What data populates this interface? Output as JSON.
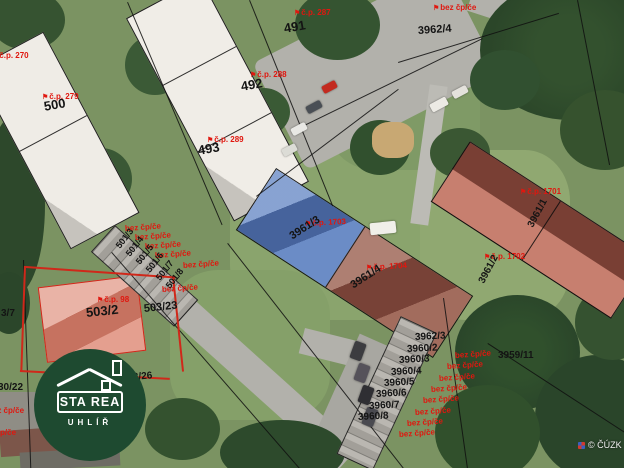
{
  "colors": {
    "label-red": "#e0170f",
    "label-black": "#141414",
    "highlight-blue": "#5a7fc0",
    "building-red-tint": "#9a5f4f",
    "house-salmon": "#e09280",
    "parcel-red-line": "#d0281a",
    "logo-green": "#1E4A30"
  },
  "icons": {
    "flag": "⚑"
  },
  "logo": {
    "line1": "STA REA",
    "line2": "UHLÍŘ"
  },
  "watermark": {
    "copyright": "© ČÚZK"
  },
  "labels": {
    "red": {
      "cp270": "č.p. 270",
      "cp279": "č.p. 279",
      "cp287": "č.p. 287",
      "cp288": "č.p. 288",
      "cp289": "č.p. 289",
      "cp98": "č.p. 98",
      "cp1701": "č.p. 1701",
      "cp1702": "č.p. 1702",
      "cp1703": "č.p. 1703",
      "cp1704": "č.p. 1704",
      "bez": "bez čp/če"
    },
    "black": {
      "p500": "500",
      "p491": "491",
      "p492": "492",
      "p493": "493",
      "p3962_4": "3962/4",
      "p3961_1": "3961/1",
      "p3961_2": "3961/2",
      "p3961_3": "3961/3",
      "p3961_4": "3961/4",
      "p503_2": "503/2",
      "p503_23": "503/23",
      "p503_26": "3/26",
      "p503_7": "3/7",
      "p30_22": "30/22",
      "p502": "502",
      "p3962_3": "3962/3",
      "p3960_2": "3960/2",
      "p3960_3": "3960/3",
      "p3960_4": "3960/4",
      "p3960_5": "3960/5",
      "p3960_6": "3960/6",
      "p3960_7": "3960/7",
      "p3960_8": "3960/8",
      "p3959_11": "3959/11",
      "p501_3": "501/3",
      "p501_4": "501/4",
      "p501_5": "501/5",
      "p501_6": "501/6",
      "p501_7": "501/7",
      "p501_8": "501/8"
    }
  }
}
